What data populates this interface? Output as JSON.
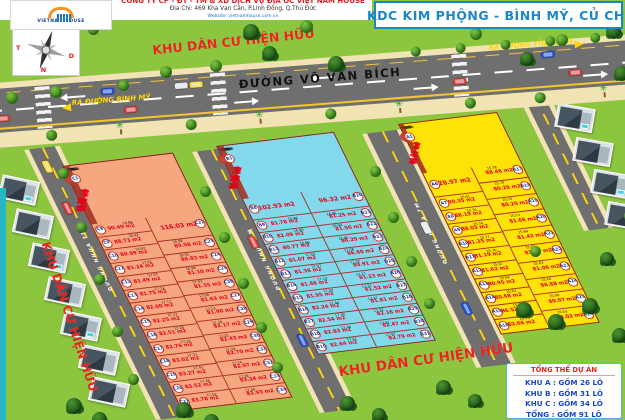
{
  "header": {
    "logo_brand": "VIETNAM HOUSE",
    "company_line": "CÔNG TY CP - ĐT - TM & XD DỊCH VỤ ĐỊA ỐC VIỆT NAM HOUSE",
    "address_line": "Địa Chỉ: 469 Kha Vạn Cân, P.Linh Đông, Q.Thủ Đức",
    "website_line": "Website: vietnamhouse.com.vn",
    "title": "KDC KIM PHỘNG   -   BÌNH MỸ, CỦ CHI"
  },
  "compass": {
    "north": "B",
    "south": "N",
    "west": "T",
    "east": "D"
  },
  "labels": {
    "existing_area": "KHU DÂN CƯ HIỆN HỮU",
    "main_road": "ĐƯỜNG VÕ VĂN BÍCH",
    "exit_left": "RA ĐƯỜNG BÌNH MỸ",
    "exit_right": "RA ĐƯỜNG TỈNH LỘ 9",
    "internal_road": "ĐƯỜNG NHỰA 7M",
    "width_dim": "5.00",
    "area_unit": "m2"
  },
  "legend": {
    "title": "TỔNG THỂ DỰ ÁN",
    "rows": [
      "KHU A : GỒM 26 LÔ",
      "KHU B : GỒM 31 LÔ",
      "KHU C : GỒM 34 LÔ",
      "TỔNG : GỒM 91 LÔ"
    ]
  },
  "colors": {
    "block_a": "#ffe208",
    "block_b": "#82d9ec",
    "block_c": "#f7a77f",
    "area_text": "#e50019",
    "banner_text": "#e8251f",
    "title_blue": "#1b87c9",
    "legend_blue": "#1747c9",
    "grass": "#8cc63f",
    "road": "#6f6f6f",
    "sidewalk": "#f2e3b4"
  },
  "blocks": {
    "C": {
      "top_row": [
        {
          "id": "C7",
          "a": "96.96"
        },
        {
          "id": "C6",
          "a": "95.77"
        },
        {
          "id": "C5",
          "a": "95.49"
        },
        {
          "id": "C4",
          "a": "91.47"
        },
        {
          "id": "C3",
          "a": "91.98"
        },
        {
          "id": "C2",
          "a": "93.30"
        },
        {
          "id": "C1",
          "a": "93.52"
        }
      ],
      "left_col": [
        {
          "id": "C8",
          "a": "90.49",
          "d": "16.88"
        },
        {
          "id": "C9",
          "a": "88.73",
          "d": "16.92"
        },
        {
          "id": "C10",
          "a": "80.99",
          "d": "16.97"
        },
        {
          "id": "C11",
          "a": "81.24",
          "d": "17.02"
        },
        {
          "id": "C12",
          "a": "81.49",
          "d": "17.07"
        },
        {
          "id": "C13",
          "a": "81.75",
          "d": "17.12"
        },
        {
          "id": "C14",
          "a": "82.00",
          "d": "17.17"
        },
        {
          "id": "C15",
          "a": "82.25",
          "d": "17.22"
        },
        {
          "id": "C16",
          "a": "82.51",
          "d": "17.28"
        },
        {
          "id": "C17",
          "a": "82.76",
          "d": "17.33"
        },
        {
          "id": "C18",
          "a": "83.02",
          "d": "17.37"
        },
        {
          "id": "C19",
          "a": "83.27",
          "d": "17.41"
        },
        {
          "id": "C20",
          "a": "83.52",
          "d": "17.46"
        },
        {
          "id": "C21",
          "a": "83.78",
          "d": "17.51"
        }
      ],
      "right_col": [
        {
          "id": "C22",
          "a": "116.03",
          "big": true
        },
        {
          "id": "C23",
          "a": "89.58",
          "d": "16.98"
        },
        {
          "id": "C24",
          "a": "86.83",
          "d": "16.53"
        },
        {
          "id": "C25",
          "a": "81.10",
          "d": "16.98"
        },
        {
          "id": "C26",
          "a": "81.35",
          "d": "17.03"
        },
        {
          "id": "C27",
          "a": "81.63",
          "d": "17.08"
        },
        {
          "id": "C28",
          "a": "81.90",
          "d": "17.13"
        },
        {
          "id": "C29",
          "a": "82.17",
          "d": "17.18"
        },
        {
          "id": "C30",
          "a": "82.43",
          "d": "17.25"
        },
        {
          "id": "C31",
          "a": "82.70",
          "d": "17.29"
        },
        {
          "id": "C32",
          "a": "82.97",
          "d": "17.34"
        },
        {
          "id": "C33",
          "a": "83.24",
          "d": "17.39"
        },
        {
          "id": "C34",
          "a": "83.93",
          "d": "17.44"
        }
      ]
    },
    "B": {
      "top_row": [
        {
          "id": "B7",
          "a": "94.84"
        },
        {
          "id": "B6",
          "a": "94.95"
        },
        {
          "id": "B5",
          "a": "95.08"
        },
        {
          "id": "B4",
          "a": "93.83"
        },
        {
          "id": "B3",
          "a": "93.63"
        },
        {
          "id": "B2",
          "a": "93.03"
        },
        {
          "id": "B1",
          "a": "87.40"
        }
      ],
      "left_col": [
        {
          "id": "B8",
          "a": "102.93",
          "big": true
        },
        {
          "id": "B9",
          "a": "81.78",
          "d": "16.96"
        },
        {
          "id": "B10",
          "a": "82.09",
          "d": "16.90"
        },
        {
          "id": "B11",
          "a": "80.77",
          "d": "16.96"
        },
        {
          "id": "B12",
          "a": "81.07",
          "d": "17.02"
        },
        {
          "id": "B13",
          "a": "81.36",
          "d": "17.07"
        },
        {
          "id": "B14",
          "a": "81.66",
          "d": "17.13"
        },
        {
          "id": "B15",
          "a": "81.95",
          "d": "17.19"
        },
        {
          "id": "B16",
          "a": "82.24",
          "d": "17.24"
        },
        {
          "id": "B17",
          "a": "82.54",
          "d": "17.30"
        },
        {
          "id": "B18",
          "a": "82.83",
          "d": "17.36"
        },
        {
          "id": "B19",
          "a": "82.64",
          "d": "17.41"
        }
      ],
      "right_col": [
        {
          "id": "B20",
          "a": "96.32",
          "big": true
        },
        {
          "id": "B21",
          "a": "81.25",
          "d": "16.86"
        },
        {
          "id": "B22",
          "a": "81.50",
          "d": "16.94"
        },
        {
          "id": "B23",
          "a": "86.29",
          "d": "17.00"
        },
        {
          "id": "B24",
          "a": "86.68",
          "d": "17.06"
        },
        {
          "id": "B25",
          "a": "80.91",
          "d": "17.12"
        },
        {
          "id": "B26",
          "a": "81.23",
          "d": "17.17"
        },
        {
          "id": "B27",
          "a": "81.52",
          "d": "17.21"
        },
        {
          "id": "B28",
          "a": "81.81",
          "d": "17.27"
        },
        {
          "id": "B29",
          "a": "82.16",
          "d": "17.32"
        },
        {
          "id": "B30",
          "a": "82.47",
          "d": "17.41"
        },
        {
          "id": "B31",
          "a": "82.79",
          "d": "17.47"
        }
      ]
    },
    "A": {
      "top_row": [
        {
          "id": "A5",
          "a": "88.88"
        },
        {
          "id": "A4",
          "a": "89.11"
        },
        {
          "id": "A3",
          "a": "91.61"
        },
        {
          "id": "A2",
          "a": "92.49"
        },
        {
          "id": "A1",
          "a": "91.11"
        }
      ],
      "left_col": [
        {
          "id": "A6",
          "a": "128.97",
          "big": true
        },
        {
          "id": "A7",
          "a": "90.35",
          "d": "15.61"
        },
        {
          "id": "A8",
          "a": "88.19",
          "d": "15.76"
        },
        {
          "id": "A9",
          "a": "88.03",
          "d": "15.76"
        },
        {
          "id": "A10",
          "a": "81.35",
          "d": "15.77"
        },
        {
          "id": "A11",
          "a": "81.19",
          "d": "15.70"
        },
        {
          "id": "A12",
          "a": "81.62",
          "d": "15.67"
        },
        {
          "id": "A13",
          "a": "80.95",
          "d": "15.64"
        },
        {
          "id": "A14",
          "a": "80.68",
          "d": "15.62"
        },
        {
          "id": "A15",
          "a": "86.52",
          "d": "15.58"
        },
        {
          "id": "A16",
          "a": "82.66",
          "d": "15.56"
        }
      ],
      "right_col": [
        {
          "id": "A17",
          "a": "88.46",
          "d": "15.78"
        },
        {
          "id": "A18",
          "a": "80.29",
          "d": "15.78"
        },
        {
          "id": "A19",
          "a": "80.20",
          "d": "15.76"
        },
        {
          "id": "A20",
          "a": "81.66",
          "d": "15.72"
        },
        {
          "id": "A21",
          "a": "81.42",
          "d": "15.69"
        },
        {
          "id": "A22",
          "a": "81.24",
          "d": "15.67"
        },
        {
          "id": "A23",
          "a": "81.06",
          "d": "15.63"
        },
        {
          "id": "A24",
          "a": "86.88",
          "d": "15.60"
        },
        {
          "id": "A25",
          "a": "80.97",
          "d": "15.56"
        },
        {
          "id": "A26",
          "a": "86.02",
          "d": "15.53"
        }
      ]
    }
  }
}
